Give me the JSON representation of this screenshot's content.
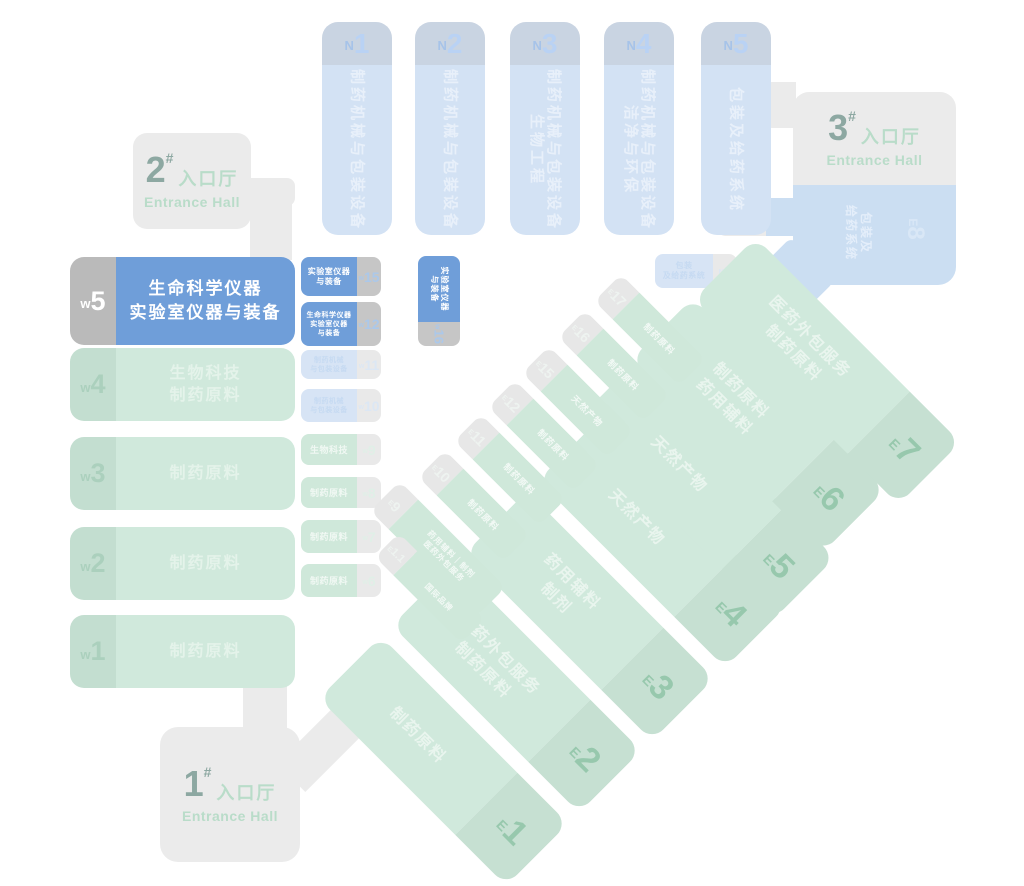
{
  "map": {
    "north_halls": [
      {
        "letter": "N",
        "num": "1",
        "line1": "制药机械与包装设备",
        "line2": ""
      },
      {
        "letter": "N",
        "num": "2",
        "line1": "制药机械与包装设备",
        "line2": ""
      },
      {
        "letter": "N",
        "num": "3",
        "line1": "制药机械与包装设备",
        "line2": "生物工程"
      },
      {
        "letter": "N",
        "num": "4",
        "line1": "制药机械与包装设备",
        "line2": "洁净与环保"
      },
      {
        "letter": "N",
        "num": "5",
        "line1": "包装及给药系统",
        "line2": ""
      }
    ],
    "n6": {
      "letter": "N",
      "num": "6",
      "line1": "包装",
      "line2": "及给药系统"
    },
    "west_main": [
      {
        "letter": "w",
        "num": "5",
        "line1": "生命科学仪器",
        "line2": "实验室仪器与装备"
      },
      {
        "letter": "w",
        "num": "4",
        "line1": "生物科技",
        "line2": "制药原料"
      },
      {
        "letter": "w",
        "num": "3",
        "line1": "制药原料",
        "line2": ""
      },
      {
        "letter": "w",
        "num": "2",
        "line1": "制药原料",
        "line2": ""
      },
      {
        "letter": "w",
        "num": "1",
        "line1": "制药原料",
        "line2": ""
      }
    ],
    "west_small": [
      {
        "letter": "w",
        "num": "15",
        "line1": "实验室仪器",
        "line2": "与装备",
        "line3": ""
      },
      {
        "letter": "w",
        "num": "12",
        "line1": "生命科学仪器",
        "line2": "实验室仪器",
        "line3": "与装备"
      },
      {
        "letter": "w",
        "num": "11",
        "line1": "制药机械",
        "line2": "与包装设备",
        "line3": ""
      },
      {
        "letter": "w",
        "num": "10",
        "line1": "制药机械",
        "line2": "与包装设备",
        "line3": ""
      },
      {
        "letter": "w",
        "num": "9",
        "line1": "生物科技",
        "line2": "",
        "line3": ""
      },
      {
        "letter": "w",
        "num": "8",
        "line1": "制药原料",
        "line2": "",
        "line3": ""
      },
      {
        "letter": "w",
        "num": "7",
        "line1": "制药原料",
        "line2": "",
        "line3": ""
      },
      {
        "letter": "w",
        "num": "6",
        "line1": "制药原料",
        "line2": "",
        "line3": ""
      }
    ],
    "w16": {
      "letter": "w",
      "num": "16",
      "line1": "实验室仪器",
      "line2": "与装备"
    },
    "east_big": [
      {
        "letter": "E",
        "num": "1",
        "line1": "制药原料",
        "line2": ""
      },
      {
        "letter": "E",
        "num": "2",
        "line1": "医药外包服务",
        "line2": "制药原料"
      },
      {
        "letter": "E",
        "num": "3",
        "line1": "药用辅料",
        "line2": "制剂"
      },
      {
        "letter": "E",
        "num": "4",
        "line1": "天然产物",
        "line2": ""
      },
      {
        "letter": "E",
        "num": "5",
        "line1": "天然产物",
        "line2": ""
      },
      {
        "letter": "E",
        "num": "6",
        "line1": "制药原料",
        "line2": "药用辅料"
      },
      {
        "letter": "E",
        "num": "7",
        "line1": "医药外包服务",
        "line2": "制药原料"
      }
    ],
    "east_small": [
      {
        "letter": "E",
        "num": "17",
        "line1": "制药原料",
        "line2": ""
      },
      {
        "letter": "E",
        "num": "16",
        "line1": "制药原料",
        "line2": ""
      },
      {
        "letter": "E",
        "num": "15",
        "line1": "天然产物",
        "line2": ""
      },
      {
        "letter": "E",
        "num": "12",
        "line1": "制药原料",
        "line2": ""
      },
      {
        "letter": "E",
        "num": "11",
        "line1": "制药原料",
        "line2": ""
      },
      {
        "letter": "E",
        "num": "10",
        "line1": "制药原料",
        "line2": ""
      },
      {
        "letter": "E",
        "num": "9",
        "line1": "药用辅料｜制剂",
        "line2": "医药外包服务"
      },
      {
        "letter": "E",
        "num": "1.1",
        "line1": "国际品牌",
        "line2": ""
      }
    ],
    "e8": {
      "letter": "E",
      "num": "8",
      "line1": "包装及",
      "line2": "给药系统"
    },
    "entrances": [
      {
        "num": "1",
        "hash": "#",
        "cn": "入口厅",
        "en": "Entrance Hall"
      },
      {
        "num": "2",
        "hash": "#",
        "cn": "入口厅",
        "en": "Entrance Hall"
      },
      {
        "num": "3",
        "hash": "#",
        "cn": "入口厅",
        "en": "Entrance Hall"
      }
    ]
  },
  "colors": {
    "background": "#ffffff",
    "corridor_gray": "#ebebeb",
    "entrance_number": "#8da8a2",
    "entrance_green_text": "#b9dcc9",
    "north_hall_body": "#d3e2f4",
    "north_hall_cap": "#c9d4e2",
    "highlight_blue": "#6f9ed9",
    "highlight_cap_gray": "#bababa",
    "light_blue_body": "#d7e4f5",
    "green_hall_body": "#d0e9dc",
    "green_hall_cap": "#c6e0d2",
    "green_label": "#97c8ad",
    "e8_blue": "#cbdef2"
  }
}
